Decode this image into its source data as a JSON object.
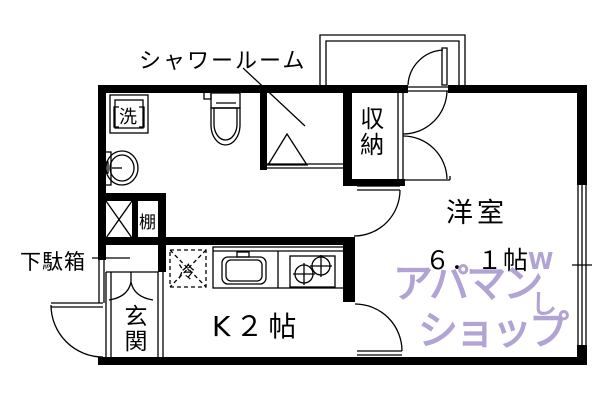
{
  "floorplan": {
    "labels": {
      "shower_room": "シャワールーム",
      "closet": "収納",
      "room": "洋室",
      "room_size": "６．１帖",
      "shoe_cabinet": "下駄箱",
      "entrance": "玄関",
      "kitchen": "K２帖",
      "washer": "洗",
      "fridge": "冷",
      "shelf": "棚"
    },
    "watermark": {
      "line1": "アパマン",
      "mark1": "W",
      "line2": "ショップ",
      "mark2": "し",
      "color": "#b1a3d3"
    },
    "colors": {
      "walls": "#000000",
      "background": "#ffffff"
    }
  }
}
